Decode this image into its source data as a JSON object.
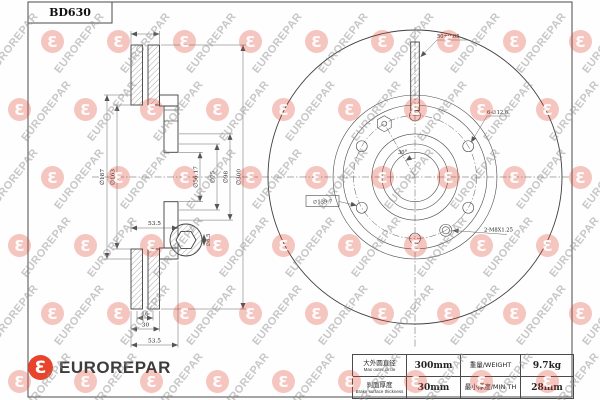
{
  "title_block": {
    "part_number": "BD630"
  },
  "watermark": {
    "text": "EUROREPAR",
    "logo_glyph": "Ɛ"
  },
  "brand": {
    "name": "EUROREPAR",
    "logo_glyph": "Ɛ"
  },
  "left_view": {
    "dims": {
      "hat_outer": "∅187",
      "hat_inner": "∅163",
      "bore": "∅56.17",
      "register": "∅75",
      "hub": "∅98",
      "outer": "∅300",
      "height_mid": "53.5",
      "flange_thickness": "16",
      "disc_thickness": "30",
      "height_bottom": "53.5",
      "hex_detail": "∅6.5"
    }
  },
  "right_view": {
    "labels": {
      "stud": "50±0.05",
      "bolt_holes": "6-∅12.6",
      "pcd": "∅139.7",
      "service_holes": "2-M8X1.25",
      "angle": "30°"
    }
  },
  "spec_table": {
    "rows": [
      {
        "label_cn": "大外圆直径",
        "label_en": "Max outer circle",
        "value": "300mm",
        "label2": "重量/WEIGHT",
        "value2": "9.7kg"
      },
      {
        "label_cn": "刹面厚度",
        "label_en": "Brake surface thickness",
        "value": "30mm",
        "label2": "最小厚度/MIN TH",
        "value2": "28mm"
      }
    ]
  }
}
